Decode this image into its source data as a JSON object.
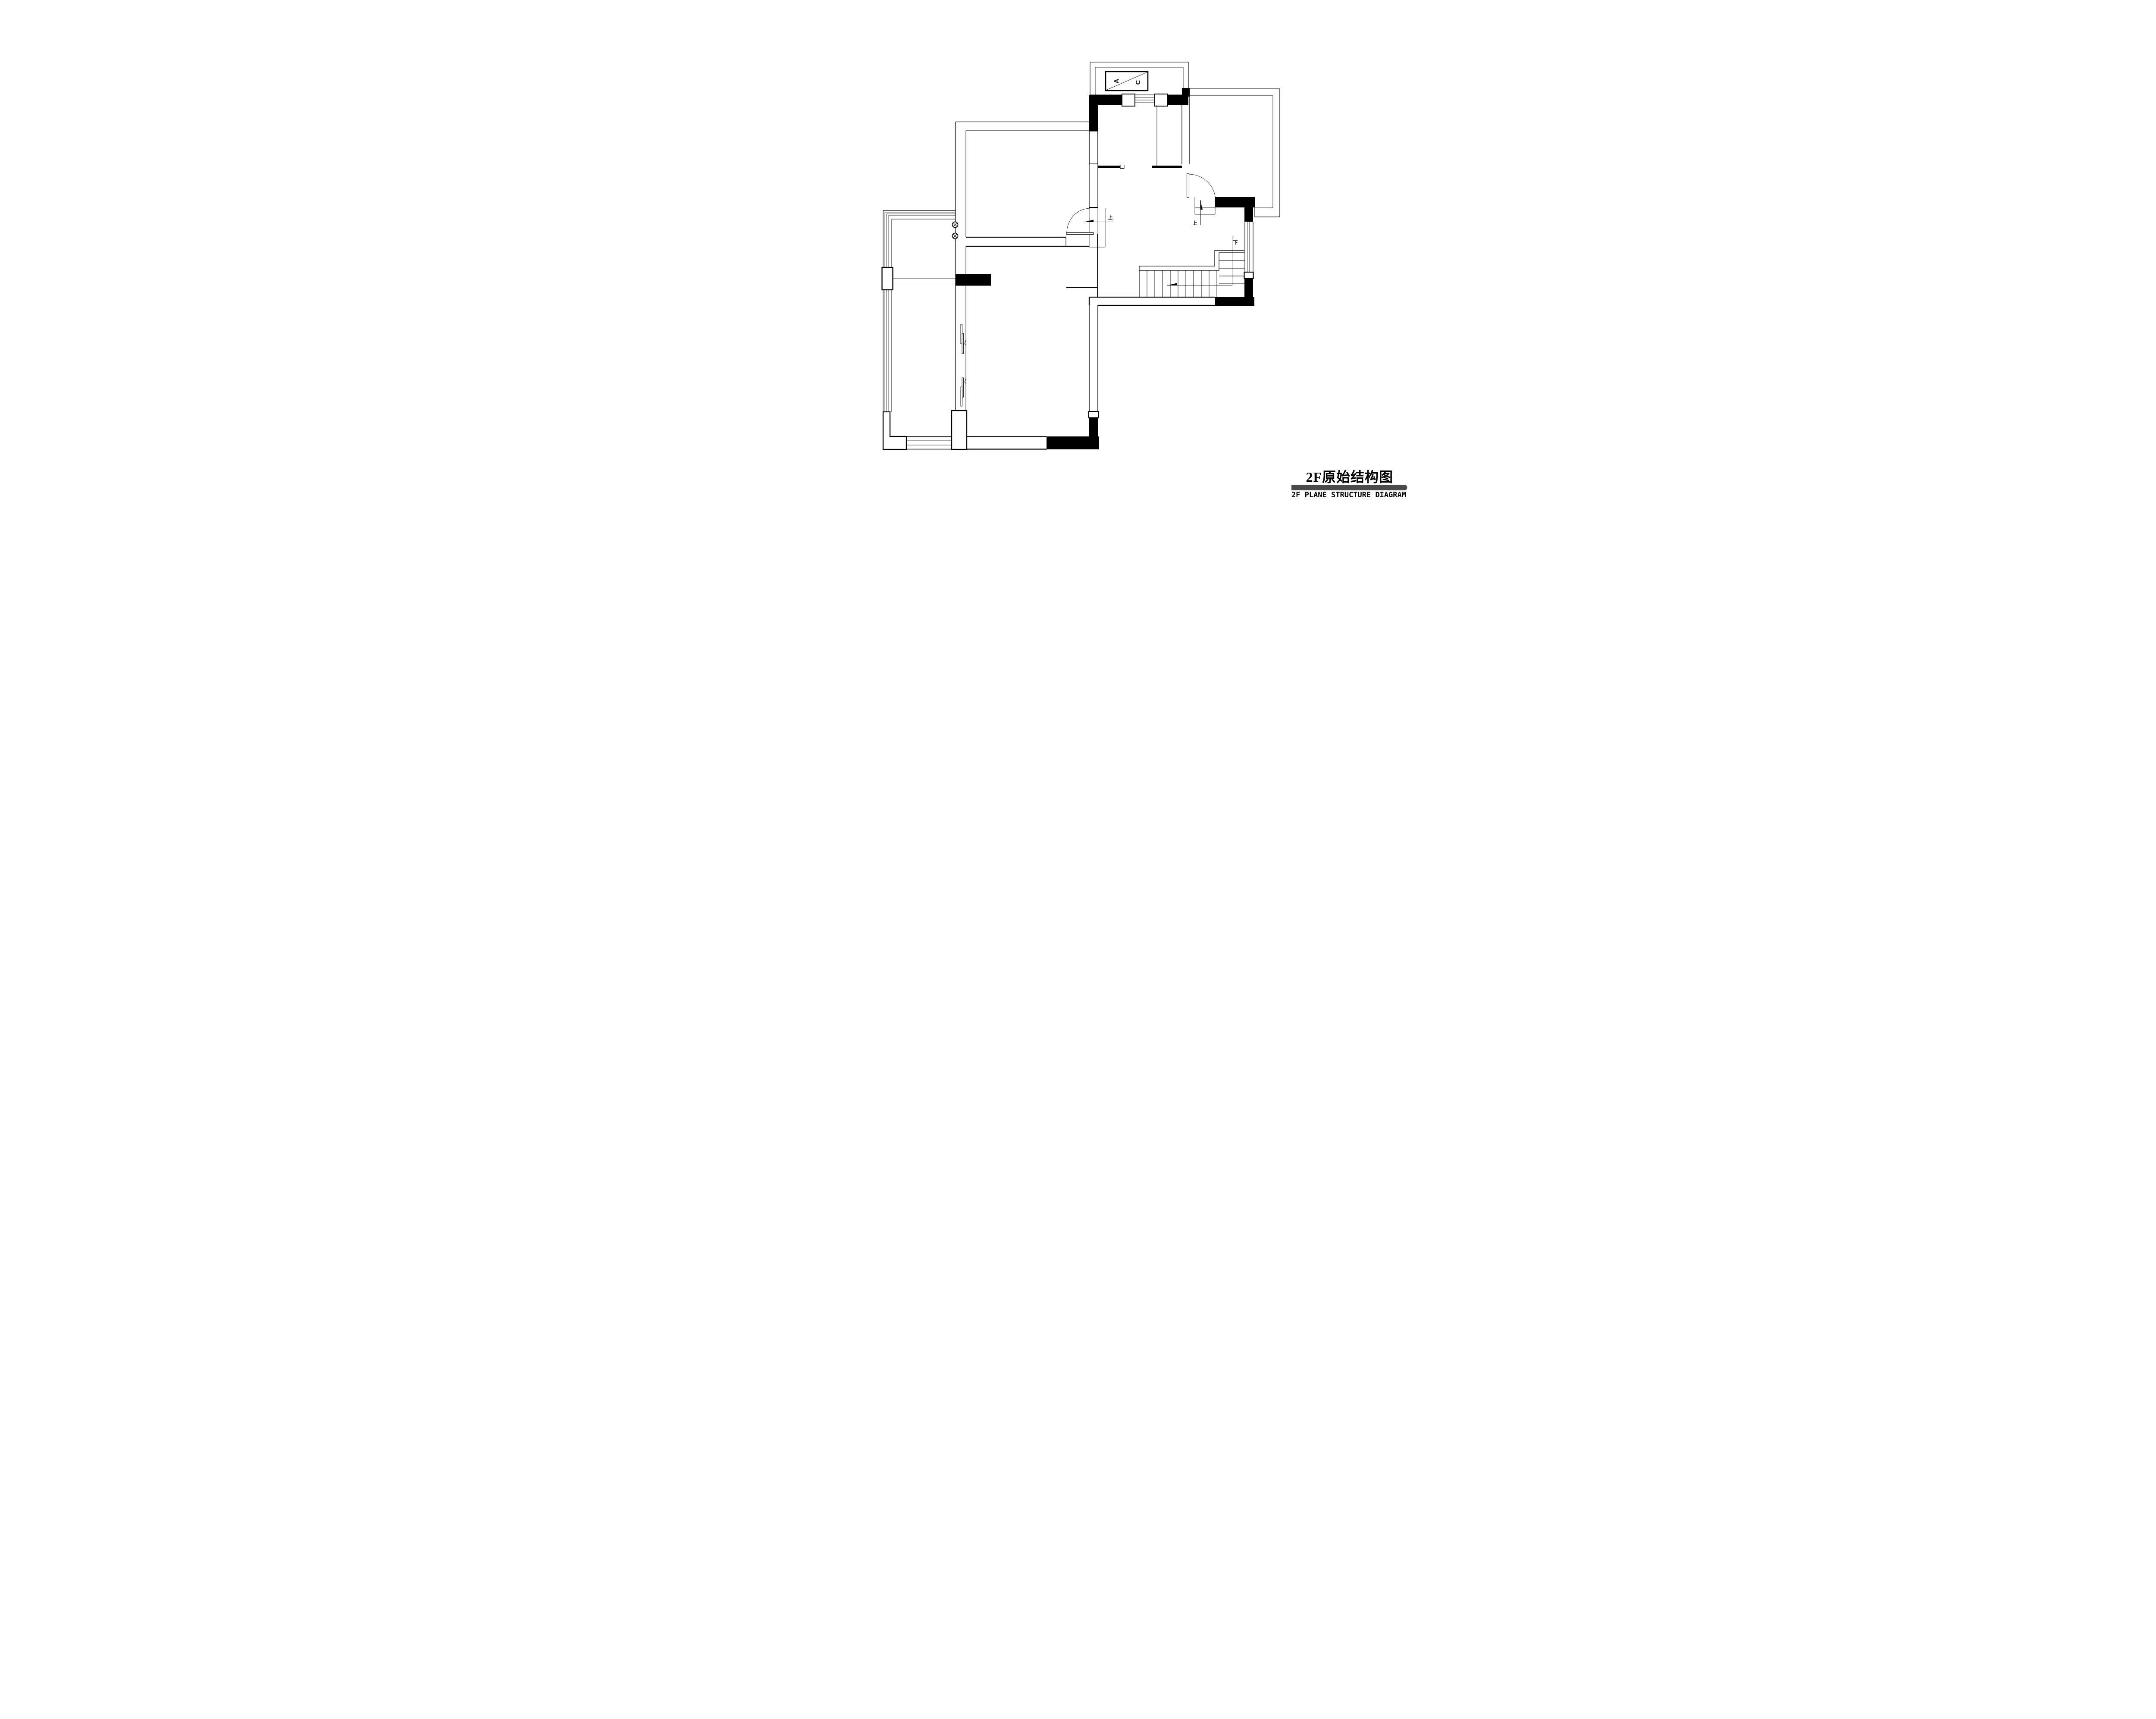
{
  "page": {
    "background": "#ffffff",
    "ink": "#000000"
  },
  "title_block": {
    "title_cn": "2F原始结构图",
    "title_en": "2F PLANE STRUCTURE DIAGRAM",
    "bar_color": "#4a4a4a"
  },
  "labels": {
    "ac_a": "A",
    "ac_c": "C",
    "up_left": "上",
    "up_right": "上",
    "down": "下"
  }
}
